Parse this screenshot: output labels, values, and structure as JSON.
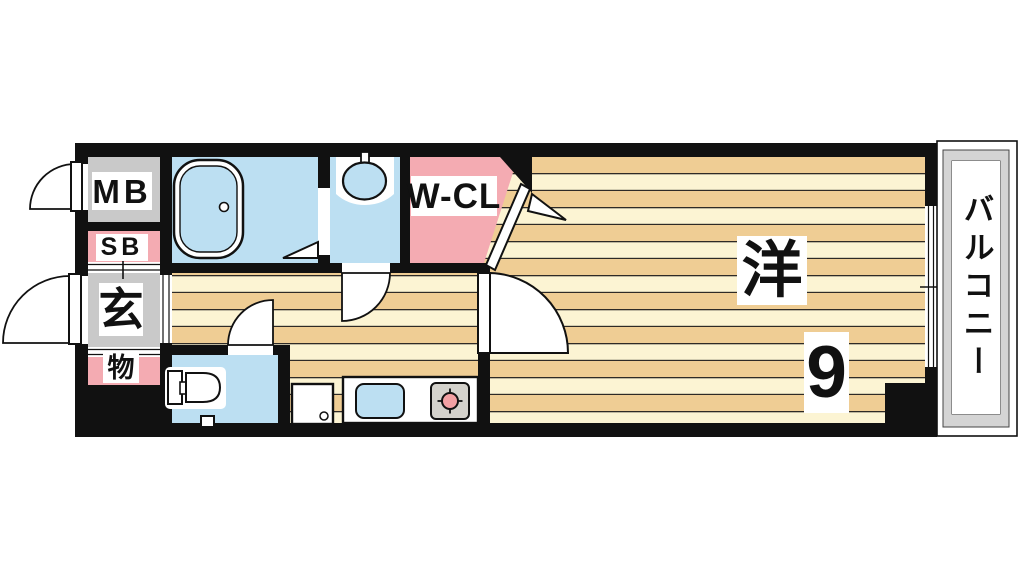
{
  "rooms": {
    "meter_box": {
      "label": "MB"
    },
    "shoe_box": {
      "label": "SB"
    },
    "entrance": {
      "label": "玄"
    },
    "storage": {
      "label": "物"
    },
    "walk_in_closet": {
      "label": "W-CL"
    },
    "western_room": {
      "label": "洋",
      "size": "9"
    },
    "balcony": {
      "label": "バルコニー"
    }
  },
  "fixtures": {
    "bathtub": "rounded-rect-tub-symbol",
    "bath_folding_door": "triangle-symbol",
    "washbasin": "oval-basin-symbol",
    "toilet": "tank-and-bowl-symbol",
    "refrigerator": "square-with-dot-symbol",
    "kitchen_sink": "blue-rounded-rect-symbol",
    "stove_burner": "circle-with-ticks-symbol",
    "door_swing": "quarter-circle-arc-symbol",
    "window": "double-line-symbol"
  },
  "colors": {
    "wall": "#111111",
    "room_gray": "#C9C9C9",
    "room_pink": "#F4ABB2",
    "room_blue": "#BCDFF2",
    "floor_cream": "#FCF4D3",
    "floor_tan": "#EFCD94",
    "stripe_line": "#2E2A26",
    "balcony_gray": "#D4D4D4",
    "burner_pink": "#F2A0A3",
    "stove_gray": "#D4D2CC"
  }
}
